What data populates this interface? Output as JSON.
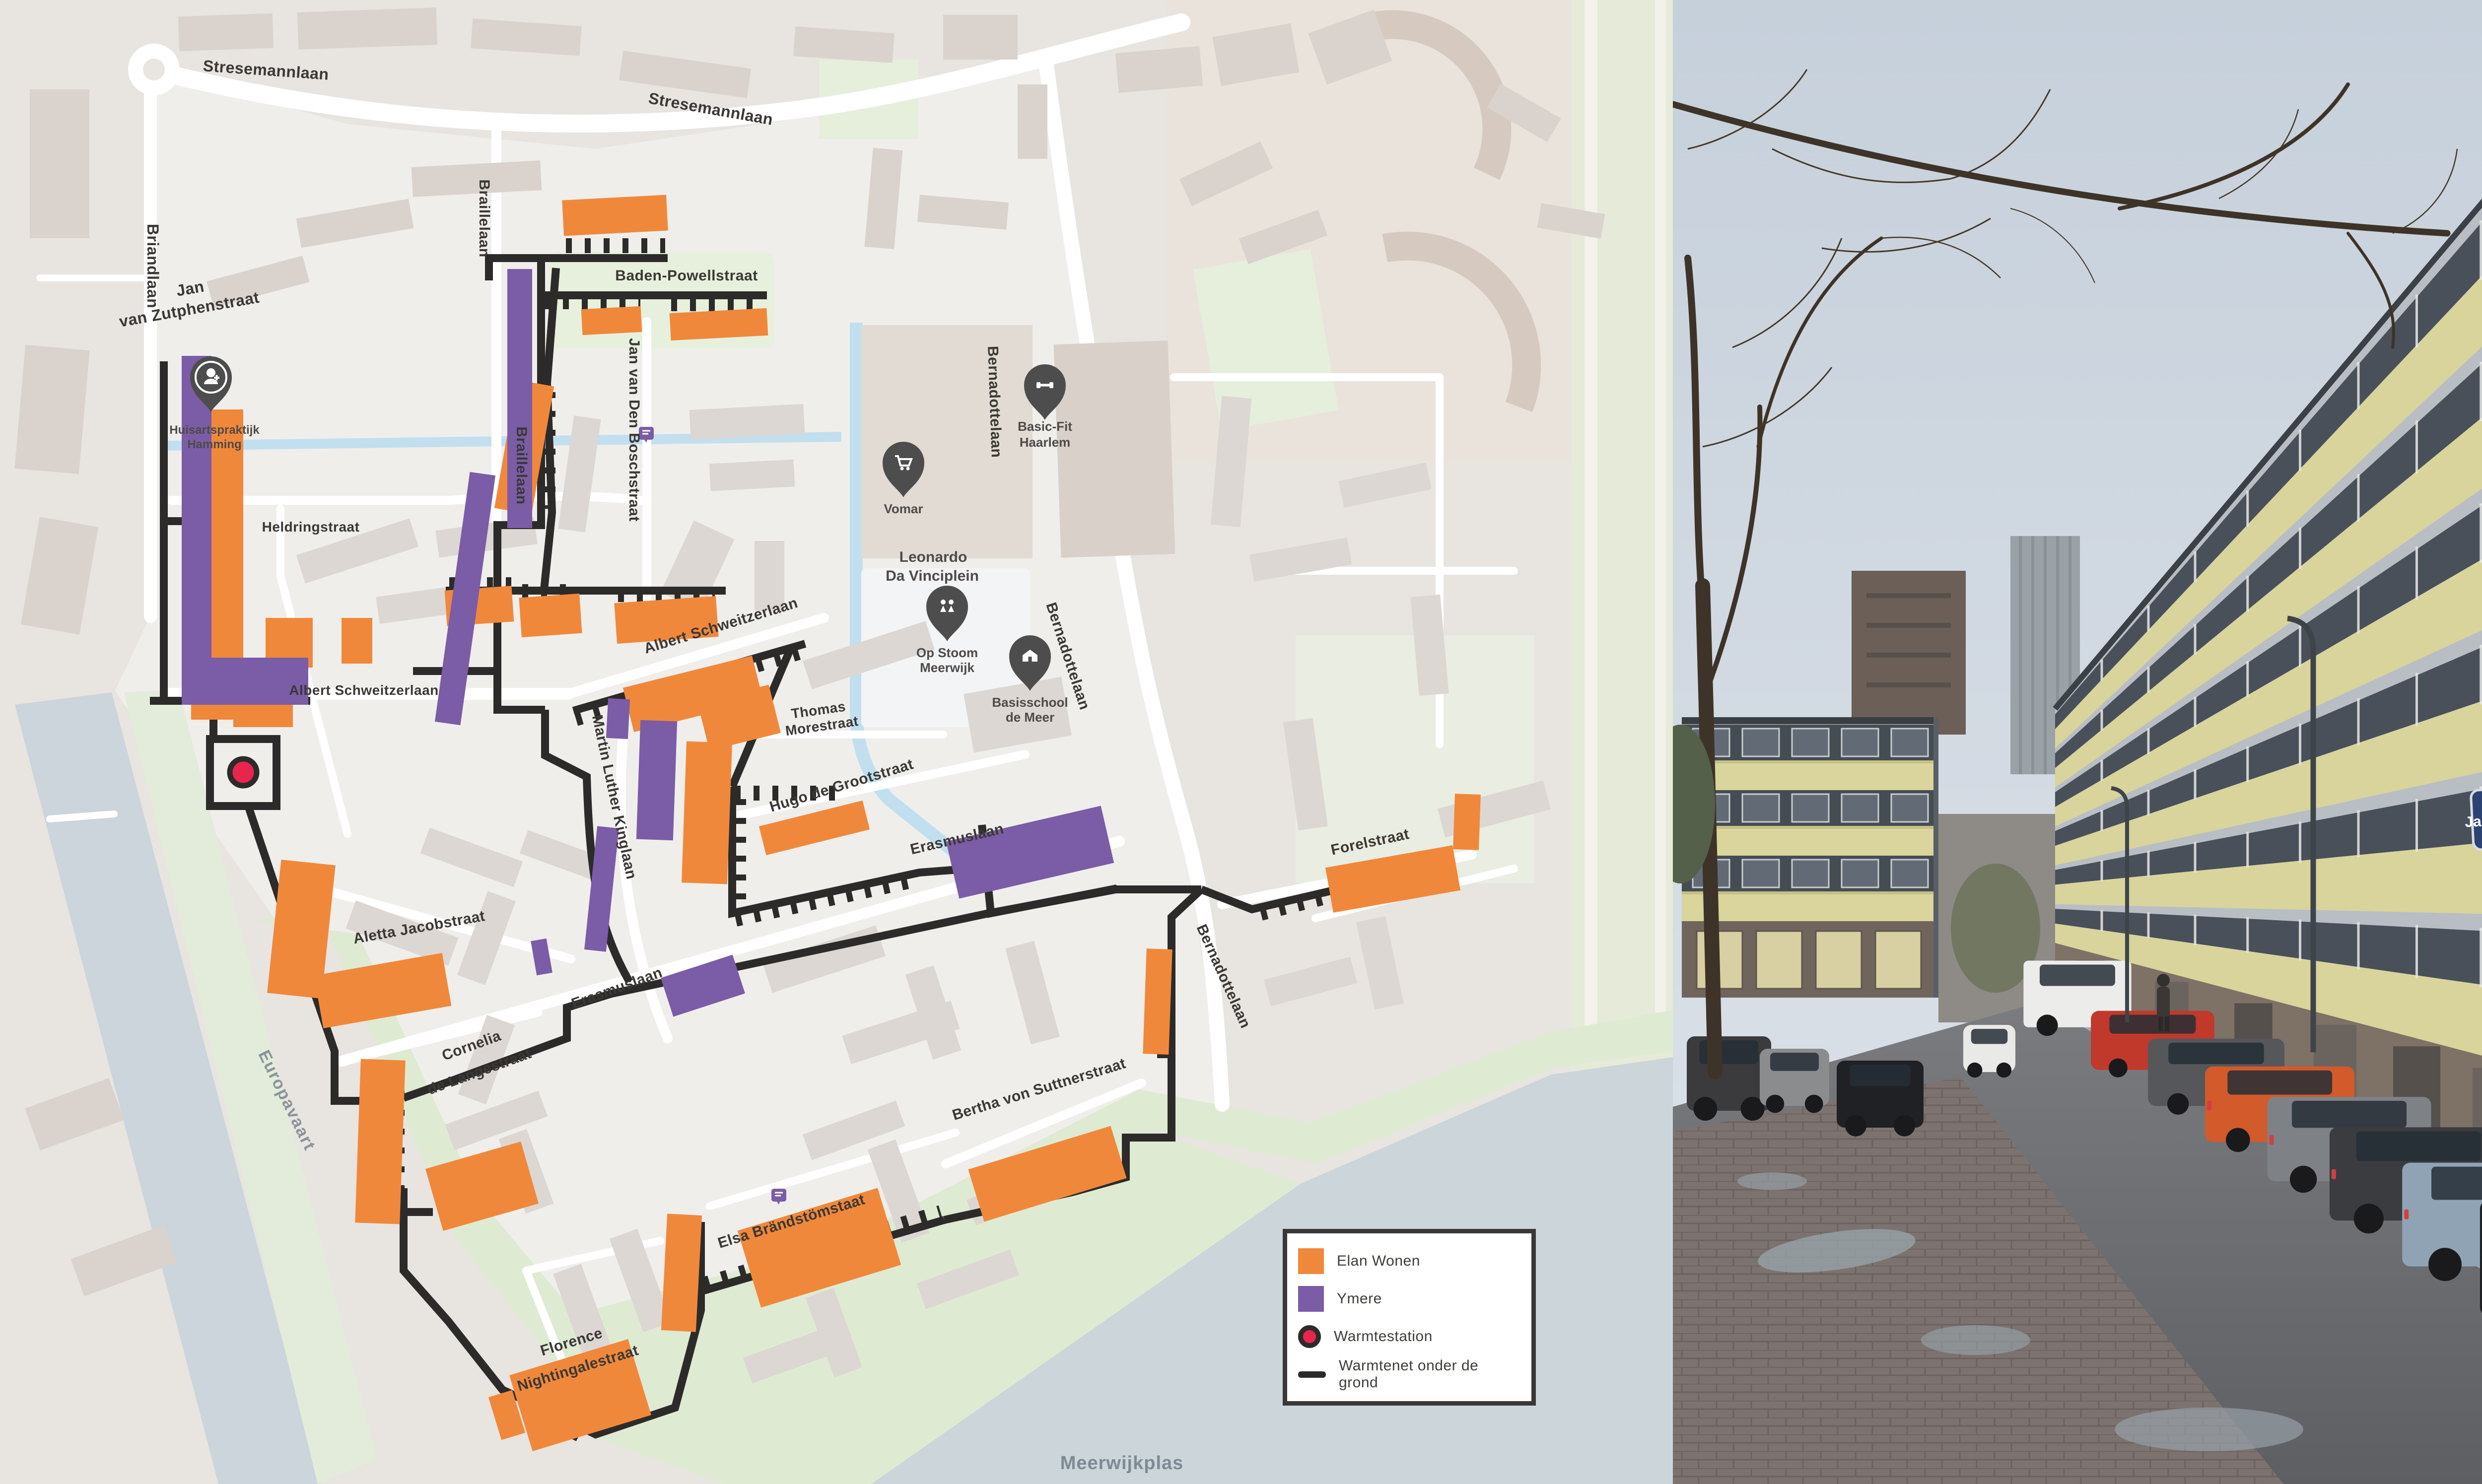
{
  "map": {
    "legend": {
      "items": [
        {
          "label": "Elan Wonen",
          "color": "#F0883B",
          "type": "square"
        },
        {
          "label": "Ymere",
          "color": "#7B5CA6",
          "type": "square"
        },
        {
          "label": "Warmtestation",
          "color": "#E8254D",
          "type": "circle"
        },
        {
          "label": "Warmtenet onder de grond",
          "color": "#2D2B2A",
          "type": "line"
        }
      ]
    },
    "street_labels": [
      {
        "text": "Stresemannlaan"
      },
      {
        "text": "Stresemannlaan"
      },
      {
        "text": "Briandlaan"
      },
      {
        "text": "Braillelaan"
      },
      {
        "text": "Braillelaan"
      },
      {
        "text": "Jan"
      },
      {
        "text": "van Zutphenstraat"
      },
      {
        "text": "Baden-Powellstraat"
      },
      {
        "text": "Jan van Den Boschstraat"
      },
      {
        "text": "Bernadottelaan"
      },
      {
        "text": "Heldringstraat"
      },
      {
        "text": "Albert Schweitzerlaan"
      },
      {
        "text": "Albert Schweitzerlaan"
      },
      {
        "text": "Martin Luther Kinglaan"
      },
      {
        "text": "Thomas"
      },
      {
        "text": "Morestraat"
      },
      {
        "text": "Hugo de Grootstraat"
      },
      {
        "text": "Erasmuslaan"
      },
      {
        "text": "Erasmuslaan"
      },
      {
        "text": "Bernadottelaan"
      },
      {
        "text": "Bernadottelaan"
      },
      {
        "text": "Aletta Jacobstraat"
      },
      {
        "text": "Cornelia"
      },
      {
        "text": "de Langestraat"
      },
      {
        "text": "Bertha von Suttnerstraat"
      },
      {
        "text": "Elsa Brändstömstaat"
      },
      {
        "text": "Florence"
      },
      {
        "text": "Nightingalestraat"
      },
      {
        "text": "Forelstraat"
      }
    ],
    "water_labels": {
      "canal": "Europavaart",
      "lake": "Meerwijkplas"
    },
    "pois": [
      {
        "name": "Huisartspraktijk Hamming",
        "lines": [
          "Huisartspraktijk",
          "Hamming"
        ],
        "icon": "doctor-pin-icon"
      },
      {
        "name": "Vomar",
        "lines": [
          "Vomar"
        ],
        "icon": "shopping-cart-pin-icon"
      },
      {
        "name": "Basic-Fit Haarlem",
        "lines": [
          "Basic-Fit",
          "Haarlem"
        ],
        "icon": "dumbbell-pin-icon"
      },
      {
        "name": "Leonardo Da Vinciplein",
        "lines": [
          "Leonardo",
          "Da Vinciplein"
        ],
        "icon": "plaza-label"
      },
      {
        "name": "Op Stoom Meerwijk",
        "lines": [
          "Op Stoom",
          "Meerwijk"
        ],
        "icon": "children-pin-icon"
      },
      {
        "name": "Basisschool de Meer",
        "lines": [
          "Basisschool",
          "de Meer"
        ],
        "icon": "school-pin-icon"
      }
    ],
    "colors": {
      "elan_wonen": "#F0883B",
      "ymere": "#7B5CA6",
      "warmtestation": "#E8254D",
      "warmtenet": "#2D2B2A",
      "water": "#CBD5DB",
      "green": "#DFEAD3",
      "road": "#FFFFFF"
    }
  },
  "photo": {
    "street_sign": "Jan van Zutphenstraat"
  }
}
